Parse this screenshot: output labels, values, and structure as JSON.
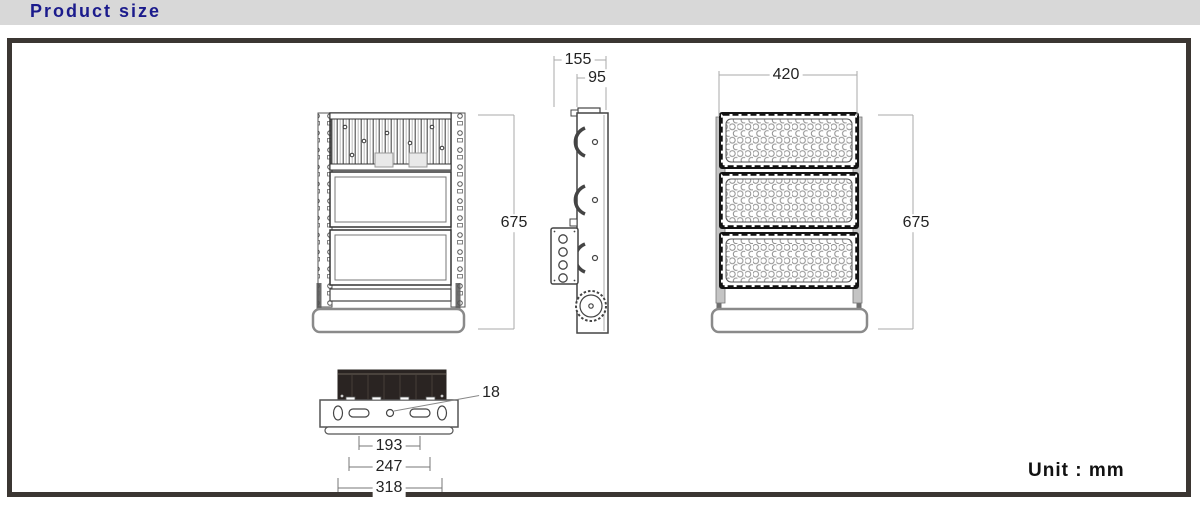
{
  "header": {
    "title": "Product size"
  },
  "footer": {
    "unit_label": "Unit : mm"
  },
  "dimensions": {
    "side_total_depth": "155",
    "side_body_depth": "95",
    "front_width": "420",
    "back_height": "675",
    "front_height": "675",
    "mount_hole": "18",
    "mount_span_inner": "193",
    "mount_span_middle": "247",
    "mount_span_outer": "318"
  },
  "colors": {
    "header_bg": "#d8d8d8",
    "header_text": "#1b1b8c",
    "frame_border": "#3b3632",
    "drawing_line": "#444444",
    "dimension_line": "#aaaaaa",
    "heatsink_fill": "#2a2422"
  }
}
